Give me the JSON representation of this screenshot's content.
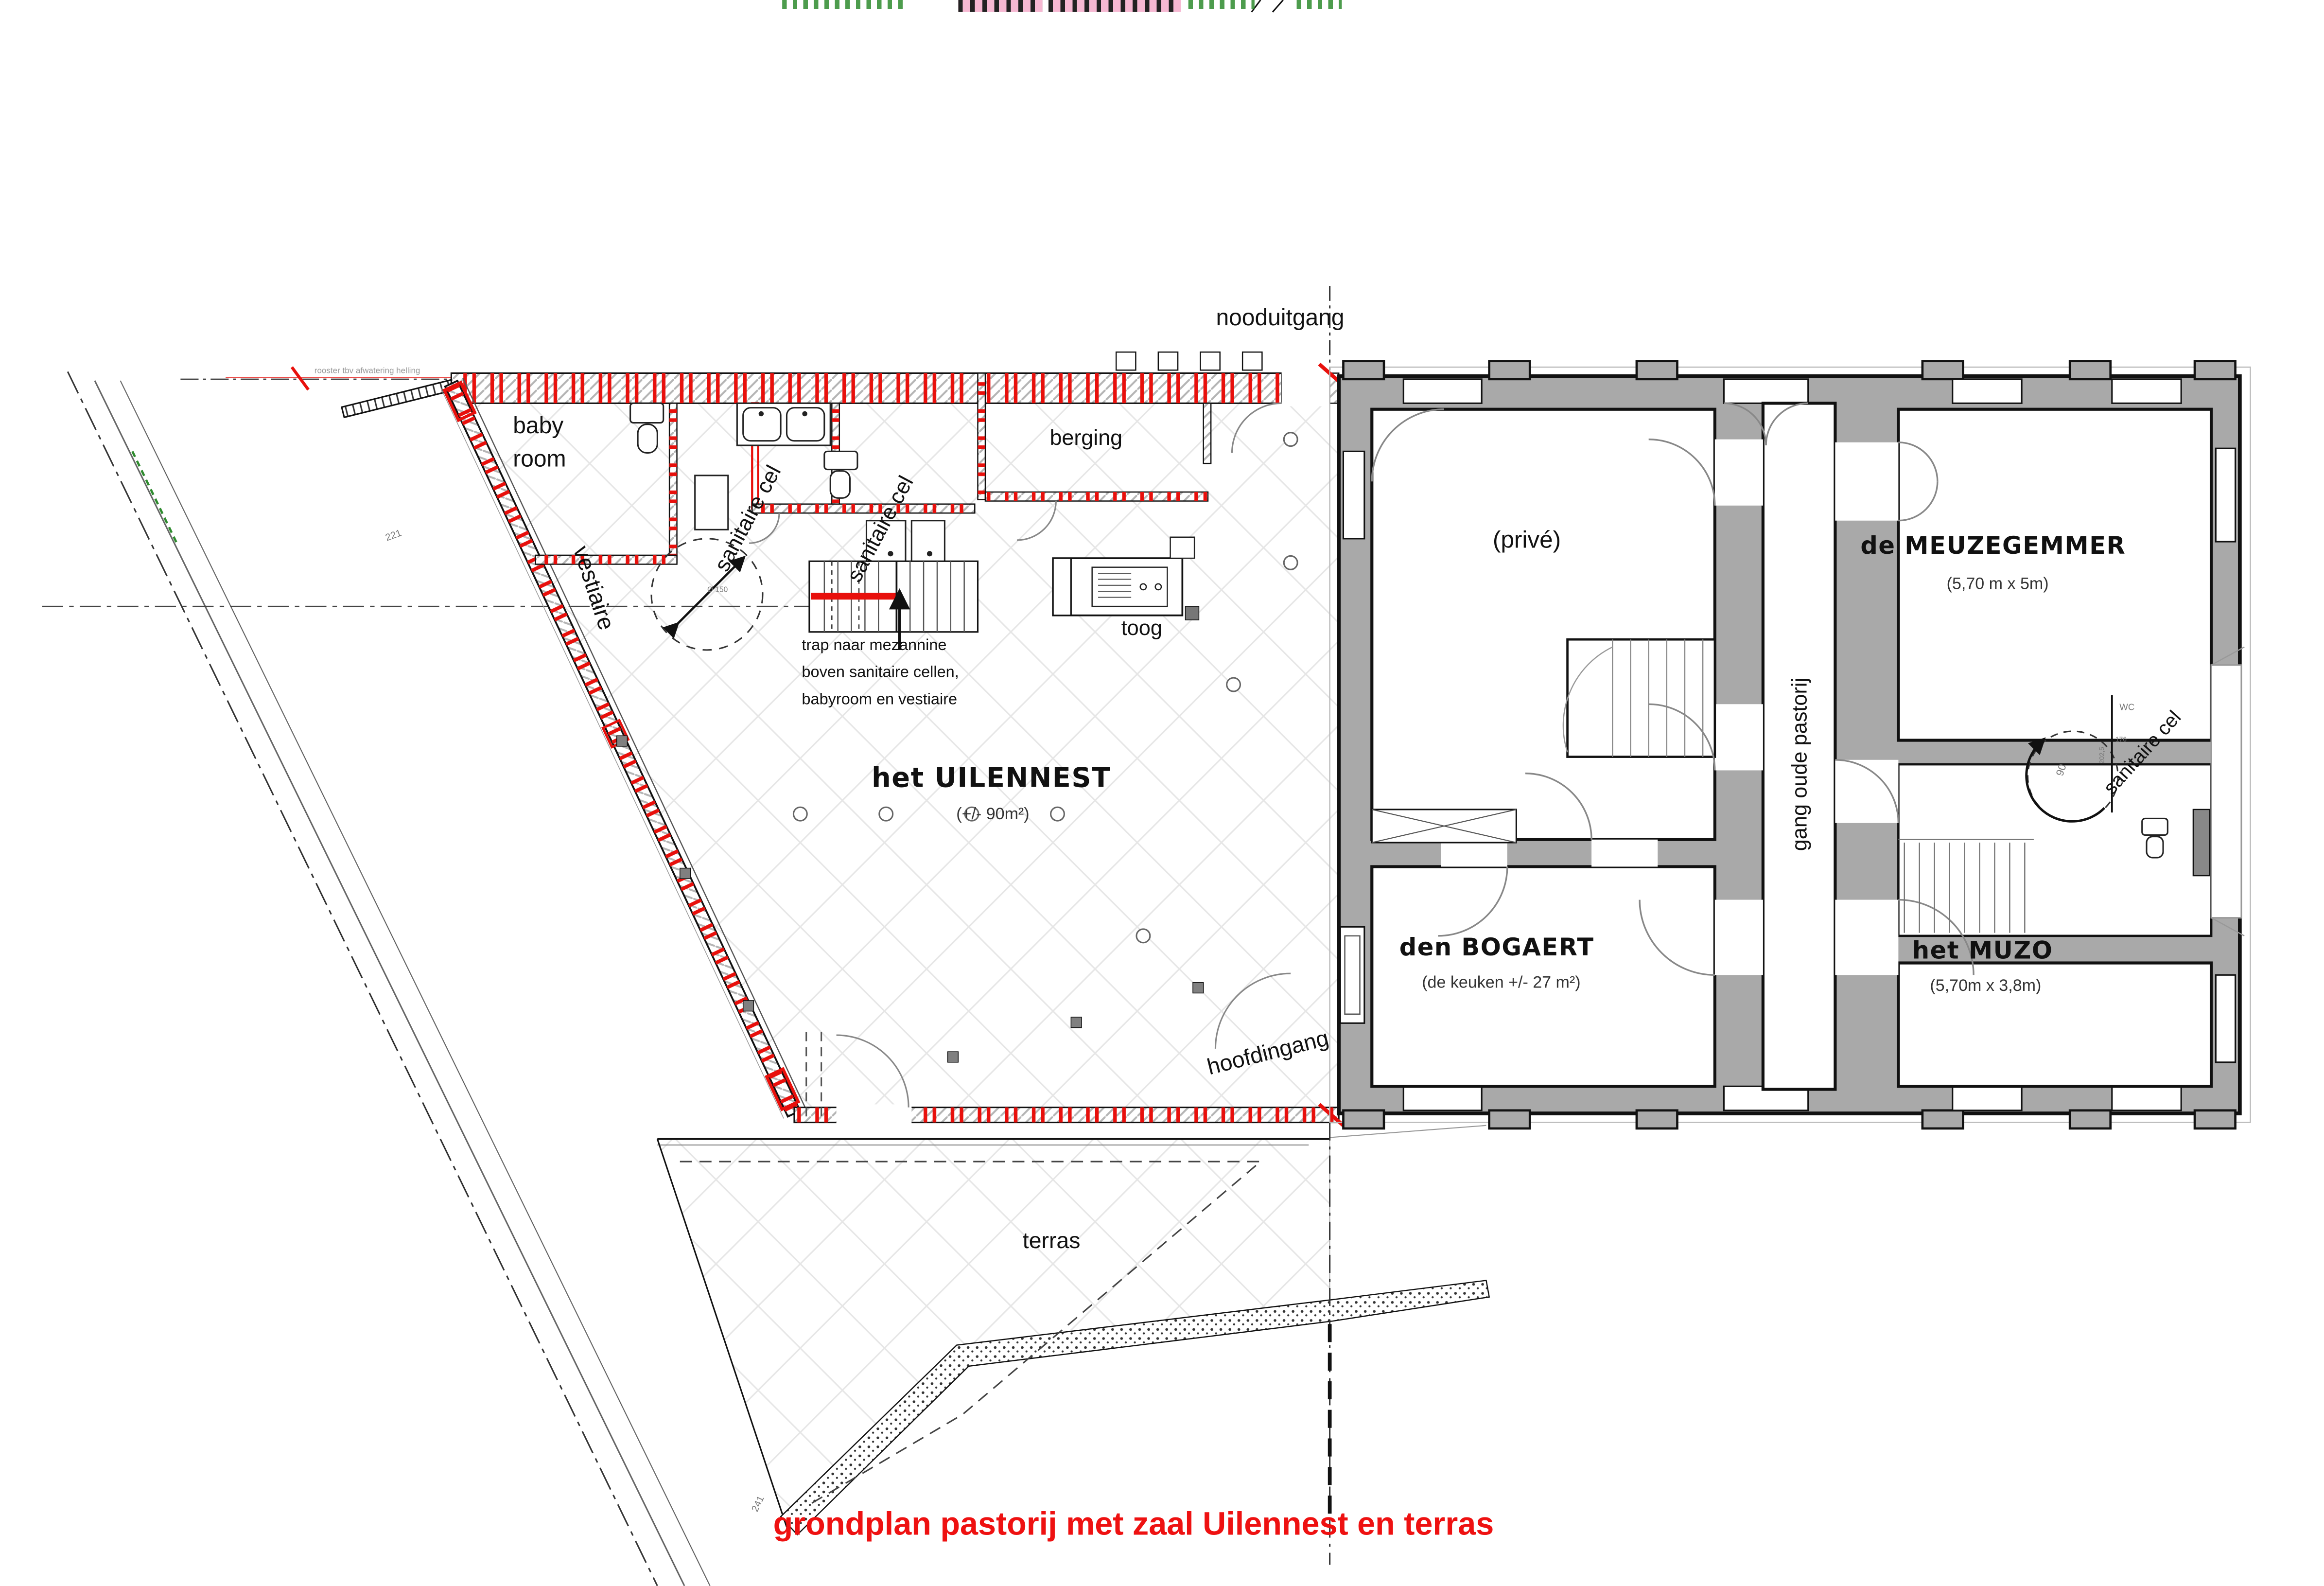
{
  "title": "grondplan pastorij met zaal Uilennest en terras",
  "hall": {
    "name": "het UILENNEST",
    "area": "(+/- 90m²)",
    "babyroom_l1": "baby",
    "babyroom_l2": "room",
    "vestiaire": "vestiaire",
    "sanitaire_cel_a": "sanitaire cel",
    "sanitaire_cel_b": "sanitaire cel",
    "berging": "berging",
    "toog": "toog",
    "nooduitgang": "nooduitgang",
    "hoofdingang": "hoofdingang",
    "terras": "terras",
    "stair_note_l1": "trap naar mezannine",
    "stair_note_l2": "boven sanitaire cellen,",
    "stair_note_l3": "babyroom en vestiaire",
    "turning_circle": "Ø 150"
  },
  "pastorij": {
    "prive": "(privé)",
    "meuzegemmer": {
      "name": "de MEUZEGEMMER",
      "dim": "(5,70 m x 5m)"
    },
    "bogaert": {
      "name": "den BOGAERT",
      "dim": "(de keuken +/- 27 m²)"
    },
    "muzo": {
      "name": "het MUZO",
      "dim": "(5,70m x 3,8m)"
    },
    "corridor": "gang oude pastorij",
    "sanitair": {
      "label": "sanitaire cel",
      "wc": "WC",
      "swing": "90",
      "dim_a": "176",
      "dim_b": "202,5"
    }
  },
  "site": {
    "drain_note": "rooster tbv afwatering helling",
    "dim_a": "221",
    "dim_b": "241"
  },
  "colors": {
    "wall_gray": "#a9a9a9",
    "red": "#e8100c",
    "title_red": "#ee1111",
    "line": "#1a1a1a"
  }
}
